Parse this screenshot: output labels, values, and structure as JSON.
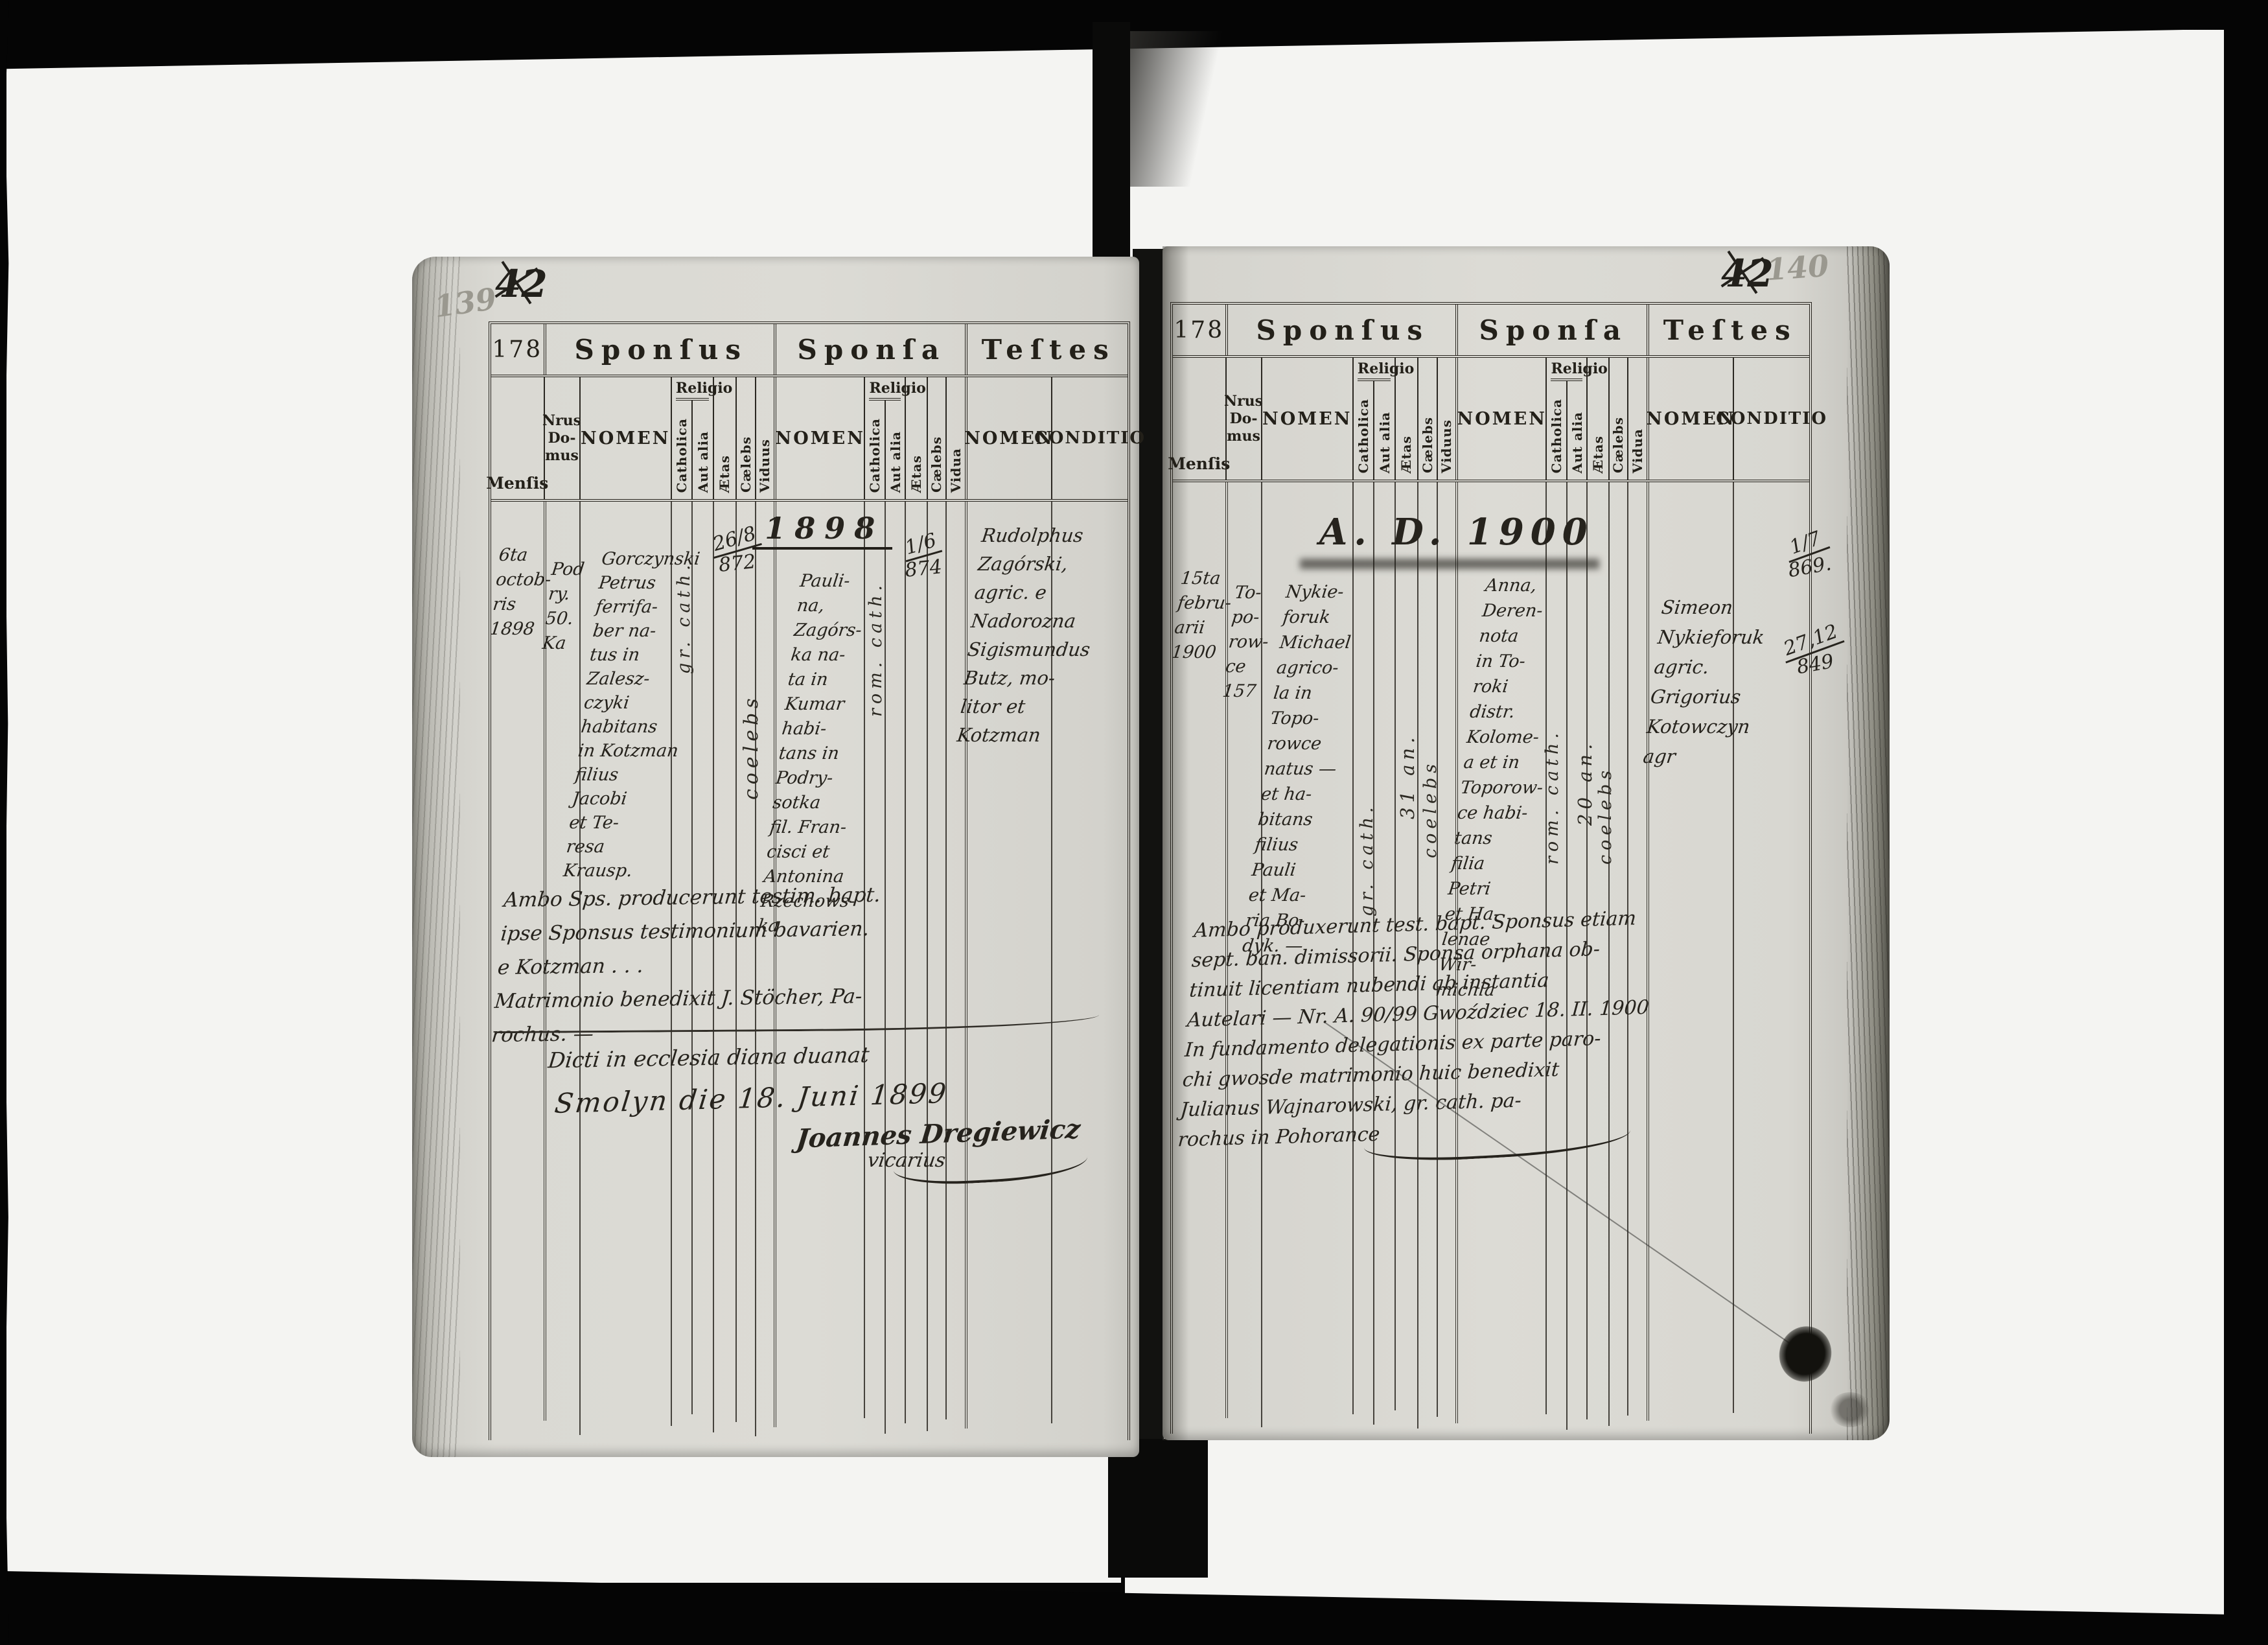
{
  "form": {
    "number": "178",
    "section_sponsus": "Sponſus",
    "section_sponsa": "Sponſa",
    "section_testes": "Teſtes",
    "col_mensis": "Menſis",
    "col_nrus_domus": [
      "Nrus",
      "Do-",
      "mus"
    ],
    "col_nomen": "NOMEN",
    "col_religio": "Religio",
    "col_catholica": "Catholica",
    "col_aut_alia": "Aut alia",
    "col_aetas": "Ætas",
    "col_caelebs": "Cælebs",
    "col_viduus": "Viduus",
    "col_vidua": "Vidua",
    "col_conditio": "CONDITIO"
  },
  "left_page": {
    "folio_pencil": "139",
    "folio_ink": "42",
    "year_heading": "1898",
    "entry": {
      "mensis": [
        "6ta",
        "octob-",
        "ris",
        "1898"
      ],
      "domus": [
        "Pod",
        "ry.",
        "50.",
        "Ka"
      ],
      "sponsus_nomen": [
        "Gorczynski",
        "Petrus",
        "ferrifa-",
        "ber na-",
        "tus in",
        "Zalesz-",
        "czyki",
        "habitans",
        "in Kotzman",
        "filius",
        "Jacobi",
        "et Te-",
        "resa",
        "Krausp."
      ],
      "sponsus_religio_note": "gr. cath.",
      "sponsus_aetas": [
        "26/8",
        "872"
      ],
      "sponsus_status_note": "coelebs",
      "sponsa_nomen": [
        "Pauli-",
        "na,",
        "Zagórs-",
        "ka na-",
        "ta in",
        "Kumar",
        "habi-",
        "tans in",
        "Podry-",
        "sotka",
        "fil. Fran-",
        "cisci et",
        "Antonina",
        "Rzechows-",
        "ka"
      ],
      "sponsa_religio_note": "rom. cath.",
      "sponsa_aetas": [
        "1/6",
        "874"
      ],
      "testes_nomen": [
        "Rudolphus",
        "Zagórski,",
        "agric. e",
        "Nadorozna",
        "Sigismundus",
        "Butz, mo-",
        "litor et",
        "Kotzman"
      ]
    },
    "note_upper": [
      "Ambo Sps. producerunt testim. bapt.",
      "ipse Sponsus testimonium bavarien.",
      "e Kotzman . . .",
      "Matrimonio benedixit J. Stöcher, Pa-",
      "rochus. —"
    ],
    "note_lower_1": "Dicti in ecclesia diana duanat",
    "note_lower_2": "Smolyn die 18. Juni 1899",
    "signature_name": "Joannes Dregiewicz",
    "signature_title": "vicarius"
  },
  "right_page": {
    "folio_ink": "42",
    "folio_pencil": "140",
    "year_heading": "A. D. 1900",
    "entry": {
      "mensis": [
        "15ta",
        "febru-",
        "arii",
        "1900"
      ],
      "domus": [
        "To-",
        "po-",
        "row-",
        "ce",
        "157"
      ],
      "sponsus_nomen": [
        "Nykie-",
        "foruk",
        "Michael",
        "agrico-",
        "la in",
        "Topo-",
        "rowce",
        "natus —",
        "et ha-",
        "bitans",
        "filius",
        "Pauli",
        "et Ma-",
        "ria Bo-",
        "dyk. —"
      ],
      "sponsus_religio_note": "gr. cath.",
      "sponsus_aetas_note": "31 an.",
      "sponsus_status_note": "coelebs",
      "sponsa_nomen": [
        "Anna,",
        "Deren-",
        "nota",
        "in To-",
        "roki",
        "distr.",
        "Kolome-",
        "a et in",
        "Toporow-",
        "ce habi-",
        "tans",
        "filia",
        "Petri",
        "et Ha-",
        "lenae",
        "Wir-",
        "michla"
      ],
      "sponsa_religio_note": "rom. cath.",
      "sponsa_aetas_note": "20 an.",
      "sponsa_status_note": "coelebs",
      "testes_nomen": [
        "Simeon",
        "Nykieforuk",
        "agric.",
        "Grigorius",
        "Kotowczyn",
        "agr"
      ],
      "margin_date_1": [
        "1/7",
        "869."
      ],
      "margin_date_2": [
        "27,12",
        "849"
      ]
    },
    "note_lines": [
      "Ambo produxerunt test. bapt. Sponsus etiam",
      "sept. ban. dimissorii. Sponsa orphana ob-",
      "tinuit licentiam nubendi ab instantia",
      "Autelari — Nr. A. 90/99 Gwoździec 18. II. 1900",
      "In fundamento delegationis ex parte paro-",
      "chi gwosde matrimonio huic benedixit",
      "Julianus Wajnarowski, gr. cath. pa-",
      "rochus in Pohorance"
    ]
  }
}
